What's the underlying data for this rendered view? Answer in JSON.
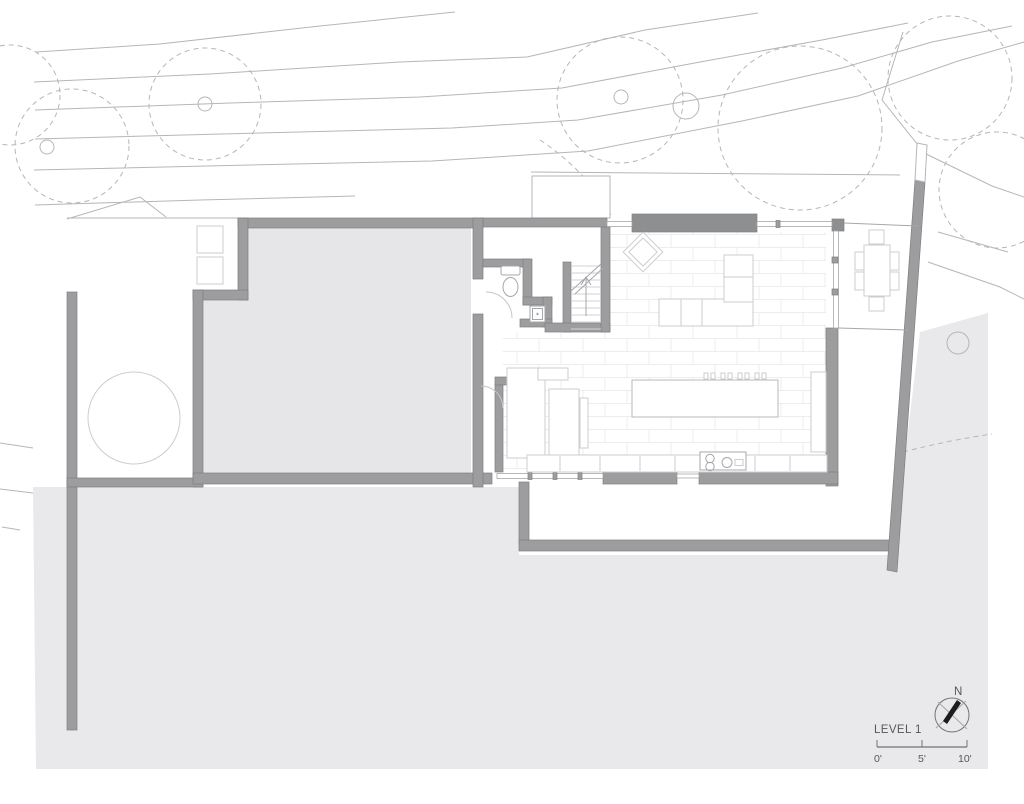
{
  "annotations": {
    "title": "LEVEL 1",
    "north_label": "N"
  },
  "scale_bar": {
    "ticks": [
      "0'",
      "5'",
      "10'"
    ]
  },
  "legend": {
    "drawing_type": "floor-plan",
    "level": "LEVEL 1"
  },
  "colors": {
    "wall": "#9d9d9f",
    "wallStroke": "#7e7f81",
    "beam": "#8e8f91",
    "garage": "#e6e6e8",
    "terrain": "#e9e9eb",
    "contour": "#b6b6b8",
    "furn": "#cdcdcf",
    "furnDark": "#b9b9bb",
    "fixture": "#a6a7a9",
    "tile": "#ededee",
    "tread": "#d2d2d4",
    "door": "#c6c6c8",
    "text": "#56575a",
    "dim": "#717275",
    "needle": "#1c1c1e"
  }
}
